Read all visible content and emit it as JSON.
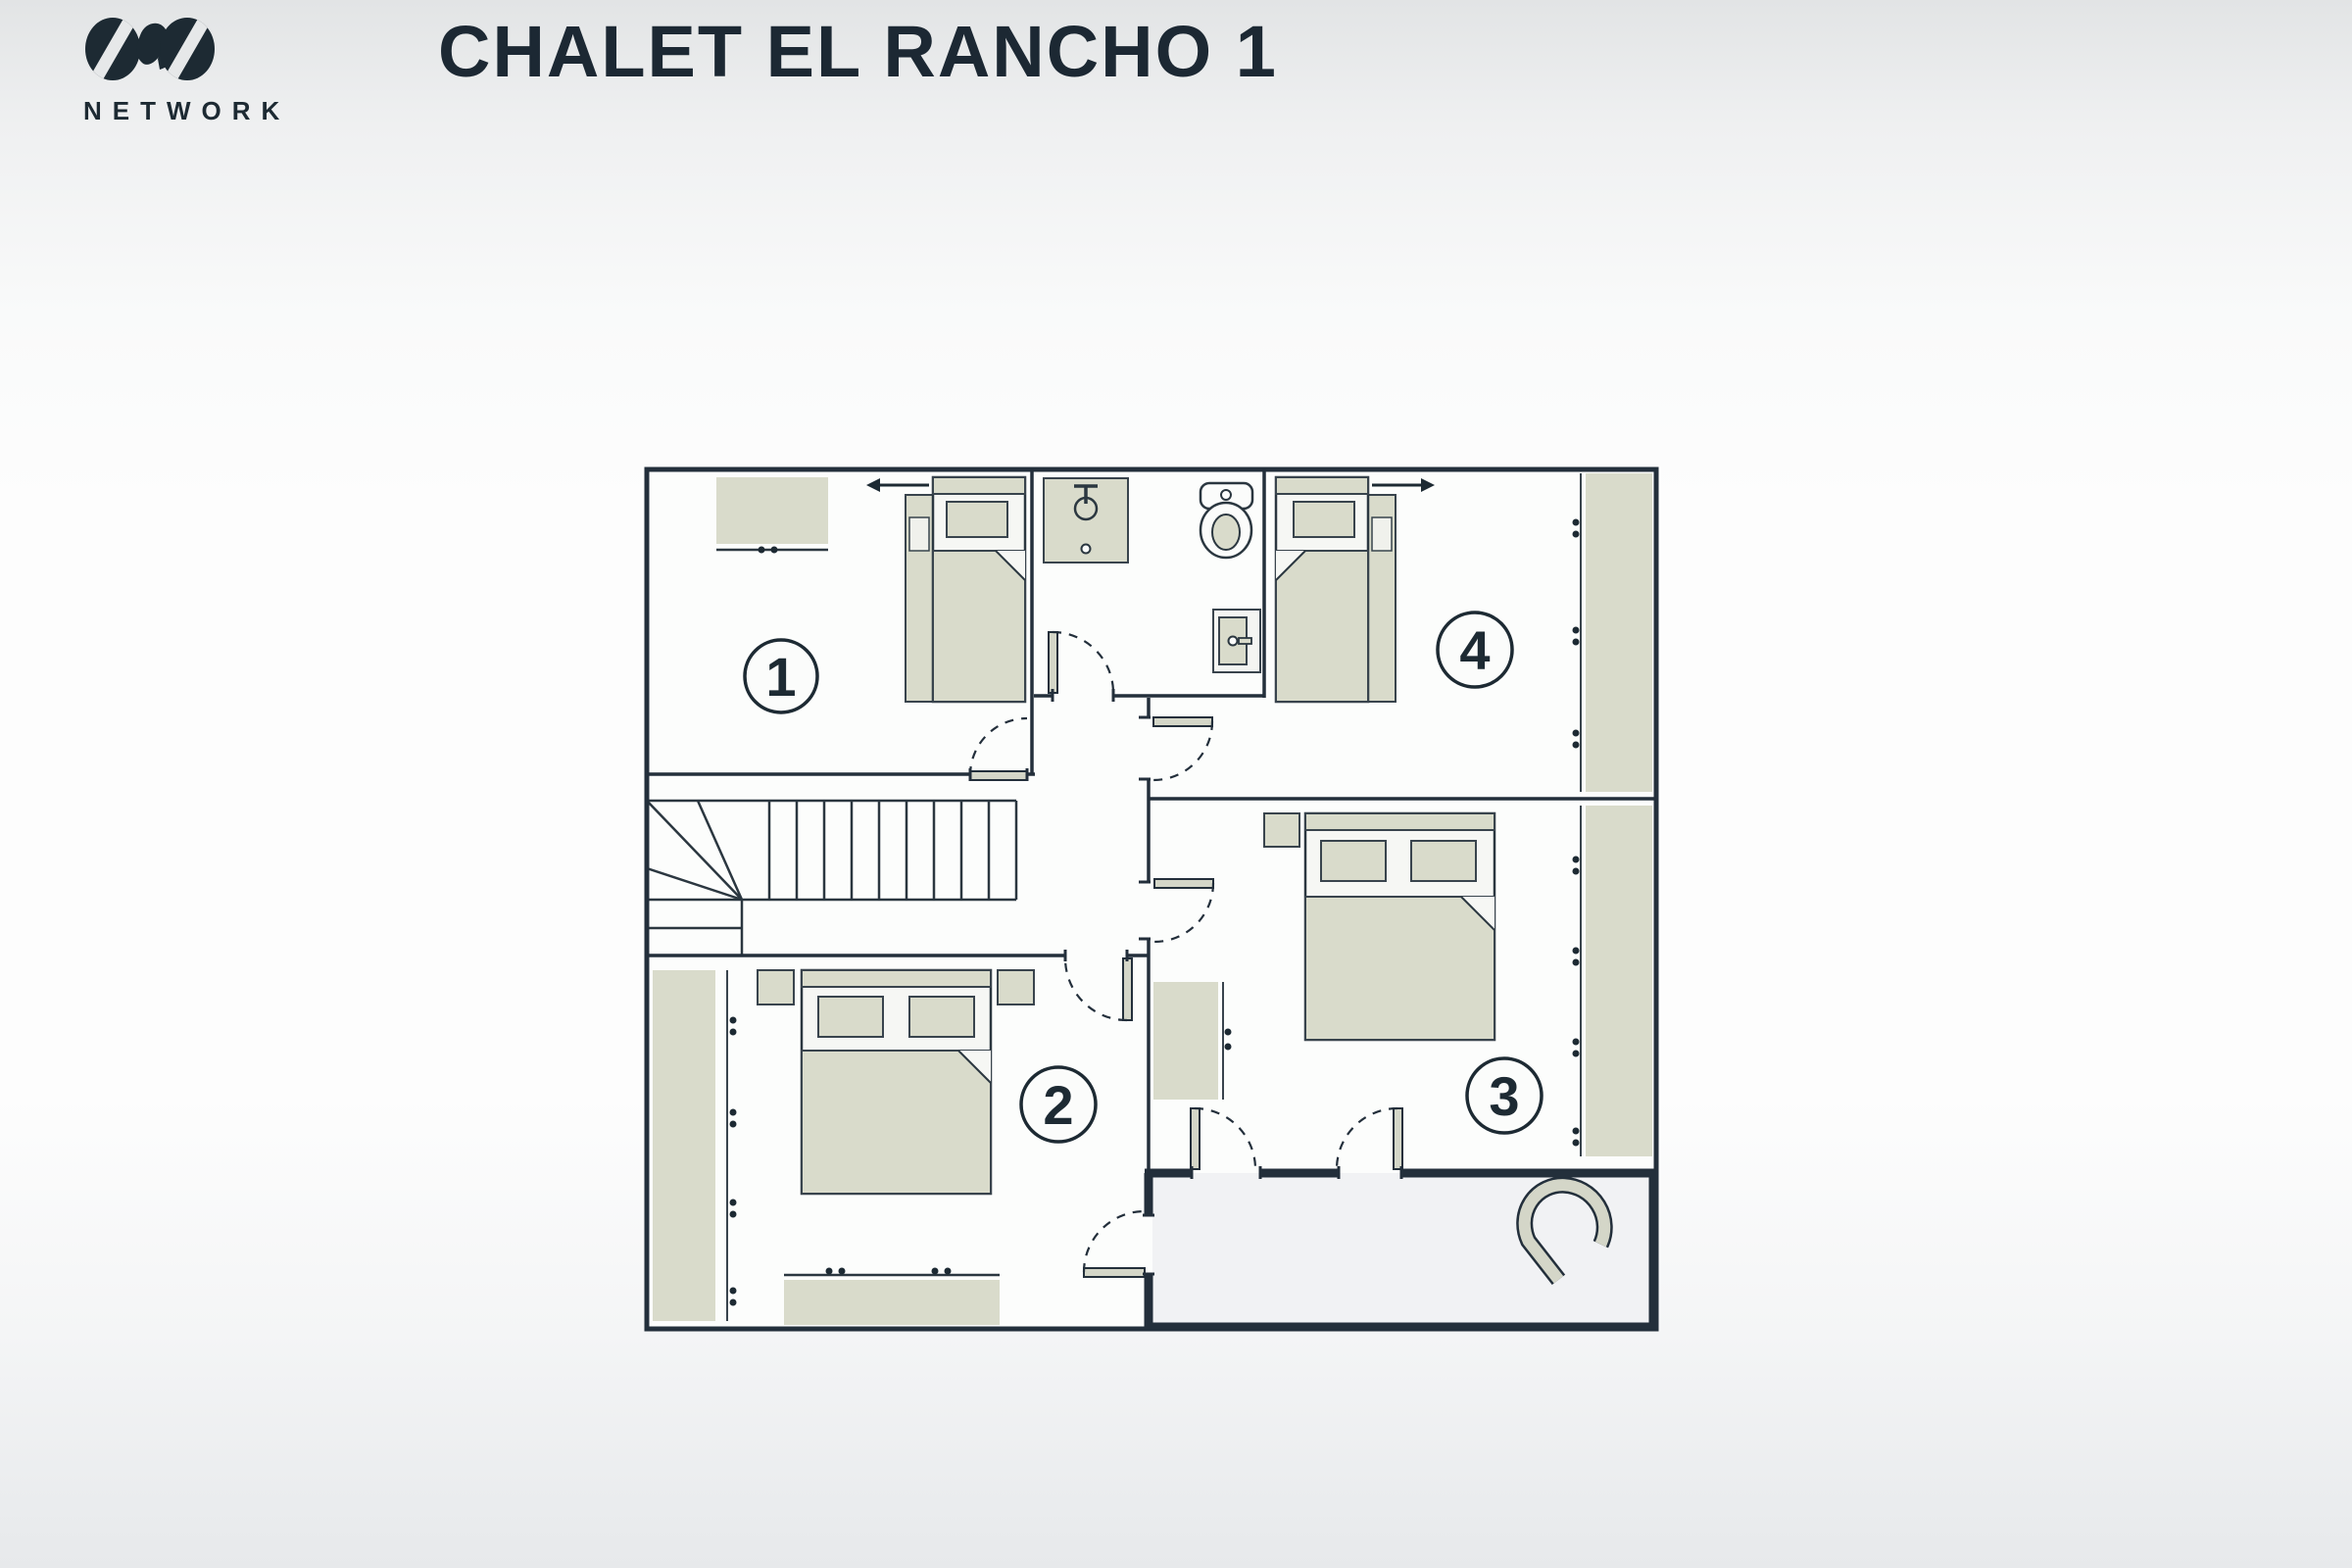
{
  "logo": {
    "brand": "NETWORK",
    "mark": "ovo-logo"
  },
  "header": {
    "title": "CHALET EL RANCHO 1"
  },
  "colors": {
    "ink": "#232f3b",
    "title": "#1c2833",
    "furniture_beige": "#d9dbcb",
    "bed_white": "#f6f7f4",
    "room_fill": "#fcfdfc",
    "ensuite_fill": "#f1f2f4",
    "background_top": "#e2e4e5",
    "background_mid": "#fdfdfd",
    "background_bottom": "#e7e9eb"
  },
  "floorplan": {
    "rooms": [
      {
        "label": "1",
        "name": "bedroom-1",
        "furniture": [
          "chest-of-drawers",
          "single-bed-with-pullout"
        ],
        "bed_extends": "left"
      },
      {
        "label": "2",
        "name": "bedroom-2",
        "furniture": [
          "wardrobe",
          "double-bed",
          "nightstand",
          "nightstand",
          "chest-of-drawers"
        ]
      },
      {
        "label": "3",
        "name": "bedroom-3",
        "furniture": [
          "nightstand",
          "double-bed",
          "side-dresser",
          "wardrobe"
        ]
      },
      {
        "label": "4",
        "name": "bedroom-4",
        "furniture": [
          "single-bed-with-pullout",
          "wardrobe"
        ],
        "bed_extends": "right"
      }
    ],
    "bathroom": {
      "fixtures": [
        "shower",
        "toilet",
        "utility-cabinet"
      ]
    },
    "ensuite": {
      "fixtures": [
        "bathtub"
      ]
    },
    "hall": {
      "features": [
        "staircase"
      ]
    },
    "door_count": 8
  }
}
